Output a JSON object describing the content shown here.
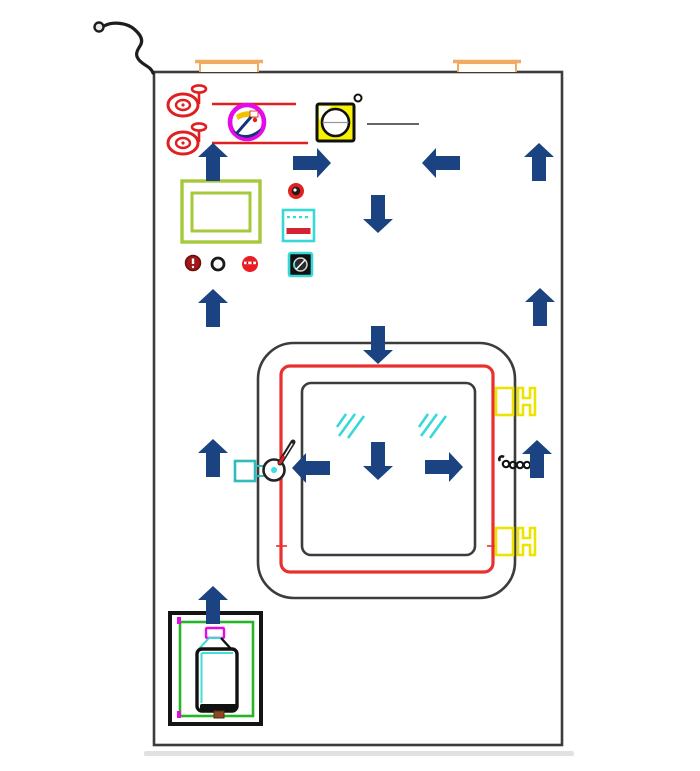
{
  "diagram": {
    "kind": "equipment-cabinet-technical-diagram",
    "background": "#ffffff",
    "visible_text": []
  },
  "colors": {
    "arrow": "#1b4382",
    "red": "#e02020",
    "red-frame": "#e8302e",
    "red-bar": "#d42432",
    "magenta": "#e60ae6",
    "gauge-yellow": "#f6f200",
    "hinge-yellow": "#ece400",
    "green": "#a6c93c",
    "bottle-green": "#28b428",
    "cyan": "#38d8d8",
    "tan": "#f0aa64",
    "outline": "#3c3c3c",
    "ink": "#151515",
    "indicator-dark-red": "#a01818",
    "indicator-red": "#ed1c24"
  },
  "arrows": [
    {
      "dir": "up",
      "cx": 213,
      "cy": 162
    },
    {
      "dir": "right",
      "cx": 312,
      "cy": 163
    },
    {
      "dir": "left",
      "cx": 441,
      "cy": 163
    },
    {
      "dir": "up",
      "cx": 539,
      "cy": 162
    },
    {
      "dir": "down",
      "cx": 378,
      "cy": 214
    },
    {
      "dir": "up",
      "cx": 213,
      "cy": 308
    },
    {
      "dir": "up",
      "cx": 540,
      "cy": 307
    },
    {
      "dir": "down",
      "cx": 378,
      "cy": 345
    },
    {
      "dir": "up",
      "cx": 213,
      "cy": 458
    },
    {
      "dir": "left",
      "cx": 311,
      "cy": 468
    },
    {
      "dir": "down",
      "cx": 378,
      "cy": 461
    },
    {
      "dir": "right",
      "cx": 444,
      "cy": 467
    },
    {
      "dir": "up",
      "cx": 537,
      "cy": 459
    },
    {
      "dir": "up",
      "cx": 213,
      "cy": 605
    }
  ],
  "components": [
    "hose-hook",
    "cabinet-body",
    "lifting-bracket-left",
    "lifting-bracket-right",
    "red-valve-upper",
    "red-valve-lower",
    "red-pipe-upper",
    "red-pipe-lower",
    "magenta-badge",
    "yellow-gauge",
    "gauge-degree-mark",
    "gauge-callout-line",
    "green-vent-frame",
    "red-knob",
    "control-display",
    "indicator-dark-red",
    "indicator-white",
    "indicator-red",
    "power-socket",
    "viewing-window-outer",
    "viewing-window-seal",
    "viewing-window-glass",
    "glass-reflection-left",
    "glass-reflection-right",
    "door-handle",
    "handle-keeper",
    "door-chain",
    "hinge-upper",
    "hinge-lower",
    "cylinder-compartment",
    "cylinder-tray",
    "gas-cylinder"
  ]
}
